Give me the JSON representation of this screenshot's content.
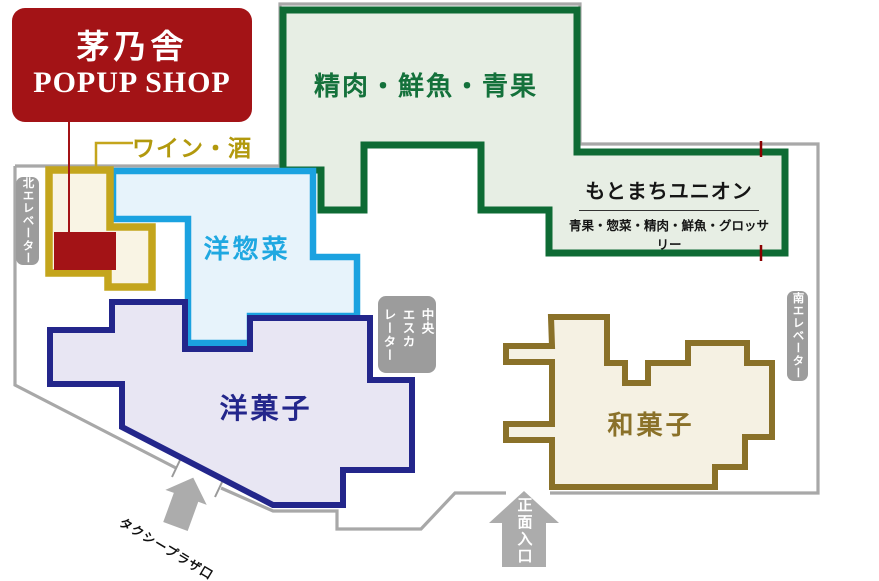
{
  "popup": {
    "title": "茅乃舎",
    "subtitle": "POPUP SHOP"
  },
  "areas": {
    "wine": "ワイン・酒",
    "meat_fish_produce": "精肉・鮮魚・青果",
    "western_deli": "洋惣菜",
    "western_sweets": "洋菓子",
    "japanese_sweets": "和菓子"
  },
  "union": {
    "name": "もとまちユニオン",
    "categories": "青果・惣菜・精肉・鮮魚・グロッサリー"
  },
  "facilities": {
    "north_elevator": "北エレベーター",
    "south_elevator": "南エレベーター",
    "central_escalator_lines": [
      "中央",
      "エスカ",
      "レーター"
    ]
  },
  "entrances": {
    "taxi": "タクシープラザ口",
    "main": "正面入口"
  },
  "map_colors": {
    "popup_red": "#A31316",
    "wine_border": "#C4A51C",
    "wine_fill": "#F9F4E4",
    "green_border": "#0E6B34",
    "green_fill": "#E7EEE4",
    "green_text": "#14713B",
    "blue_border": "#1BA2E0",
    "blue_fill": "#E7F3FB",
    "navy_border": "#23268B",
    "navy_fill": "#E8E6F3",
    "brown_border": "#8A7129",
    "brown_fill": "#F5F1E3",
    "wall_gray": "#A8A8A8",
    "label_gray": "#9C9C9C",
    "entrance_mark_red": "#8B0000"
  }
}
